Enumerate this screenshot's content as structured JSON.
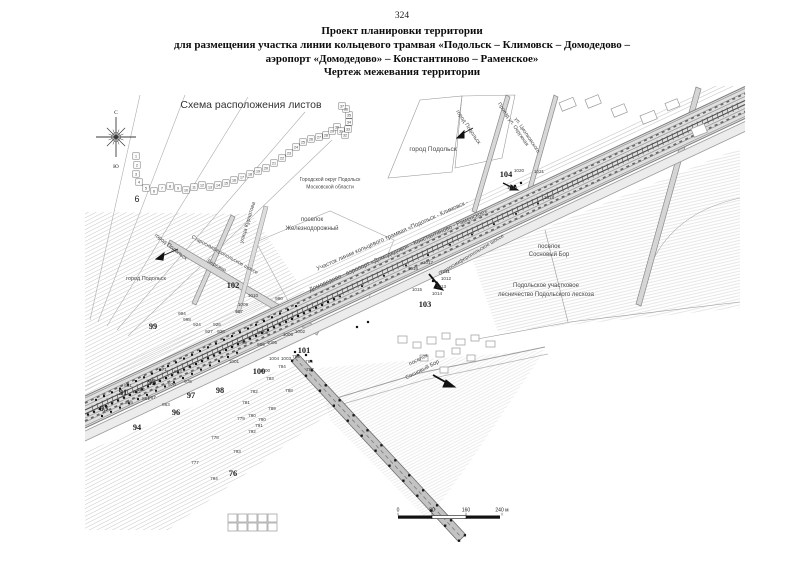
{
  "page": {
    "number": "324",
    "title_lines": [
      "Проект планировки территории",
      "для размещения участка линии кольцевого трамвая «Подольск – Климовск – Домодедово –",
      "аэропорт «Домодедово» – Константиново – Раменское»",
      "Чертеж межевания территории"
    ]
  },
  "map": {
    "compass": {
      "north": "С",
      "south": "Ю"
    },
    "scheme": {
      "chain": [
        [
          "1",
          136,
          156
        ],
        [
          "2",
          137,
          165
        ],
        [
          "3",
          136,
          174
        ],
        [
          "4",
          139,
          182
        ],
        [
          "5",
          146,
          188
        ],
        [
          "6",
          154,
          191
        ],
        [
          "7",
          162,
          188
        ],
        [
          "8",
          170,
          186
        ],
        [
          "9",
          178,
          188
        ],
        [
          "10",
          186,
          190
        ],
        [
          "11",
          194,
          187
        ],
        [
          "12",
          202,
          185
        ],
        [
          "13",
          210,
          187
        ],
        [
          "14",
          218,
          185
        ],
        [
          "15",
          226,
          183
        ],
        [
          "16",
          234,
          180
        ],
        [
          "17",
          242,
          177
        ],
        [
          "18",
          250,
          174
        ],
        [
          "19",
          258,
          171
        ],
        [
          "20",
          266,
          168
        ],
        [
          "21",
          274,
          163
        ],
        [
          "22",
          282,
          158
        ],
        [
          "23",
          289,
          153
        ],
        [
          "24",
          296,
          147
        ],
        [
          "25",
          303,
          142
        ],
        [
          "26",
          311,
          139
        ],
        [
          "27",
          319,
          137
        ],
        [
          "28",
          326,
          135
        ],
        [
          "29",
          332,
          131
        ],
        [
          "30",
          337,
          127
        ],
        [
          "31",
          341,
          131
        ],
        [
          "32",
          345,
          135
        ],
        [
          "33",
          348,
          129
        ],
        [
          "34",
          349,
          122
        ],
        [
          "35",
          349,
          115
        ],
        [
          "36",
          346,
          109
        ],
        [
          "37",
          342,
          106
        ]
      ]
    },
    "area_labels": [
      {
        "text": "Схема расположения листов",
        "x": 251,
        "y": 108,
        "size": 10.5,
        "rot": 0,
        "cls": "title"
      },
      {
        "text": "6",
        "x": 137,
        "y": 202,
        "size": 9,
        "rot": 0,
        "cls": "dark"
      },
      {
        "text": "город Подольск",
        "x": 433,
        "y": 151,
        "size": 6.5,
        "rot": 0
      },
      {
        "text": "Городской округ Подольск",
        "x": 330,
        "y": 181,
        "size": 5,
        "rot": 0
      },
      {
        "text": "Московской области",
        "x": 330,
        "y": 188.5,
        "size": 5,
        "rot": 0
      },
      {
        "text": "поселок",
        "x": 312,
        "y": 221,
        "size": 6,
        "rot": 0
      },
      {
        "text": "Железнодорожный",
        "x": 312,
        "y": 230,
        "size": 6,
        "rot": 0
      },
      {
        "text": "поселок",
        "x": 549,
        "y": 248,
        "size": 6,
        "rot": 0
      },
      {
        "text": "Сосновый Бор",
        "x": 549,
        "y": 256,
        "size": 6,
        "rot": 0
      },
      {
        "text": "Подольское участковое",
        "x": 546,
        "y": 287,
        "size": 6,
        "rot": 0
      },
      {
        "text": "лесничество Подольского лесхоза",
        "x": 546,
        "y": 296,
        "size": 6,
        "rot": 0
      },
      {
        "text": "поселок",
        "x": 419,
        "y": 361,
        "size": 5.5,
        "rot": -27
      },
      {
        "text": "Сосновый Бор",
        "x": 423,
        "y": 371,
        "size": 5.5,
        "rot": -27
      },
      {
        "text": "город Подольск",
        "x": 170,
        "y": 248,
        "size": 5.5,
        "rot": 38
      },
      {
        "text": "город Подольск",
        "x": 146,
        "y": 280,
        "size": 5.5,
        "rot": 0
      },
      {
        "text": "Старосимферопольское шоссе",
        "x": 224,
        "y": 256,
        "size": 5.2,
        "rot": 29
      },
      {
        "text": "Бережки",
        "x": 216,
        "y": 267,
        "size": 5.2,
        "rot": 29
      },
      {
        "text": "улица Курчатова",
        "x": 249,
        "y": 223,
        "size": 5.5,
        "rot": -73
      },
      {
        "text": "Старосимферопольское шоссе",
        "x": 472,
        "y": 256,
        "size": 5.2,
        "rot": -31
      },
      {
        "text": "город Подольск",
        "x": 467,
        "y": 128,
        "size": 5.5,
        "rot": 56
      },
      {
        "text": "Проезд ул. Окружная",
        "x": 512,
        "y": 125,
        "size": 5.2,
        "rot": 56
      },
      {
        "text": "ул. Циолковского",
        "x": 526,
        "y": 136,
        "size": 5.2,
        "rot": 56
      },
      {
        "text": "Участок линии кольцевого трамвая «Подольск - Климовск -",
        "x": 393,
        "y": 237,
        "size": 6,
        "rot": -24
      },
      {
        "text": "Домодедово - аэропорт «Домодедово» - Константиново - Раменское»",
        "x": 399,
        "y": 252,
        "size": 6,
        "rot": -24
      }
    ],
    "sheet_numbers": [
      [
        "104",
        506,
        177
      ],
      [
        "103",
        425,
        307
      ],
      [
        "102",
        233,
        288
      ],
      [
        "101",
        304,
        353
      ],
      [
        "100",
        259,
        374
      ],
      [
        "99",
        153,
        329
      ],
      [
        "98",
        220,
        393
      ],
      [
        "97",
        191,
        398
      ],
      [
        "96",
        176,
        415
      ],
      [
        "95",
        152,
        385
      ],
      [
        "94",
        137,
        430
      ],
      [
        "93",
        104,
        411
      ],
      [
        "91",
        123,
        395
      ],
      [
        "76",
        233,
        476
      ]
    ],
    "point_numbers": [
      [
        "1020",
        519,
        172
      ],
      [
        "1021",
        539,
        173
      ],
      [
        "1019",
        512,
        189
      ],
      [
        "1018",
        549,
        199
      ],
      [
        "1017",
        428,
        264
      ],
      [
        "1016",
        413,
        270
      ],
      [
        "1011",
        445,
        273
      ],
      [
        "1012",
        446,
        280
      ],
      [
        "1013",
        441,
        288
      ],
      [
        "1014",
        437,
        295
      ],
      [
        "1015",
        417,
        291
      ],
      [
        "1010",
        253,
        297
      ],
      [
        "1009",
        243,
        306
      ],
      [
        "990",
        279,
        300
      ],
      [
        "987",
        239,
        313
      ],
      [
        "994",
        182,
        315
      ],
      [
        "998",
        187,
        321
      ],
      [
        "924",
        197,
        326
      ],
      [
        "926",
        217,
        326
      ],
      [
        "927",
        209,
        333
      ],
      [
        "928",
        221,
        333
      ],
      [
        "1008",
        263,
        334
      ],
      [
        "1006",
        288,
        336
      ],
      [
        "1002",
        300,
        333
      ],
      [
        "1005",
        272,
        344
      ],
      [
        "999",
        261,
        346
      ],
      [
        "995",
        243,
        344
      ],
      [
        "1001",
        234,
        363
      ],
      [
        "1000",
        265,
        372
      ],
      [
        "1004",
        274,
        360
      ],
      [
        "1003",
        286,
        360
      ],
      [
        "785",
        296,
        358
      ],
      [
        "786",
        309,
        363
      ],
      [
        "787",
        310,
        371
      ],
      [
        "784",
        282,
        368
      ],
      [
        "783",
        270,
        380
      ],
      [
        "782",
        254,
        393
      ],
      [
        "781",
        246,
        404
      ],
      [
        "780",
        252,
        417
      ],
      [
        "779",
        241,
        420
      ],
      [
        "778",
        215,
        439
      ],
      [
        "777",
        195,
        464
      ],
      [
        "794",
        214,
        480
      ],
      [
        "793",
        237,
        453
      ],
      [
        "792",
        252,
        433
      ],
      [
        "791",
        259,
        427
      ],
      [
        "790",
        262,
        421
      ],
      [
        "789",
        272,
        410
      ],
      [
        "788",
        289,
        392
      ],
      [
        "970",
        172,
        386
      ],
      [
        "971",
        163,
        371
      ],
      [
        "973",
        178,
        373
      ],
      [
        "975",
        188,
        383
      ],
      [
        "967",
        152,
        399
      ],
      [
        "961",
        128,
        387
      ],
      [
        "962",
        141,
        391
      ],
      [
        "861",
        146,
        400
      ],
      [
        "862",
        137,
        393
      ],
      [
        "859",
        129,
        404
      ],
      [
        "863",
        166,
        406
      ]
    ],
    "scale_bar": {
      "ticks": [
        {
          "label": "0",
          "x": 398
        },
        {
          "label": "80",
          "x": 432
        },
        {
          "label": "160",
          "x": 466
        },
        {
          "label": "240 м",
          "x": 502
        }
      ]
    }
  }
}
